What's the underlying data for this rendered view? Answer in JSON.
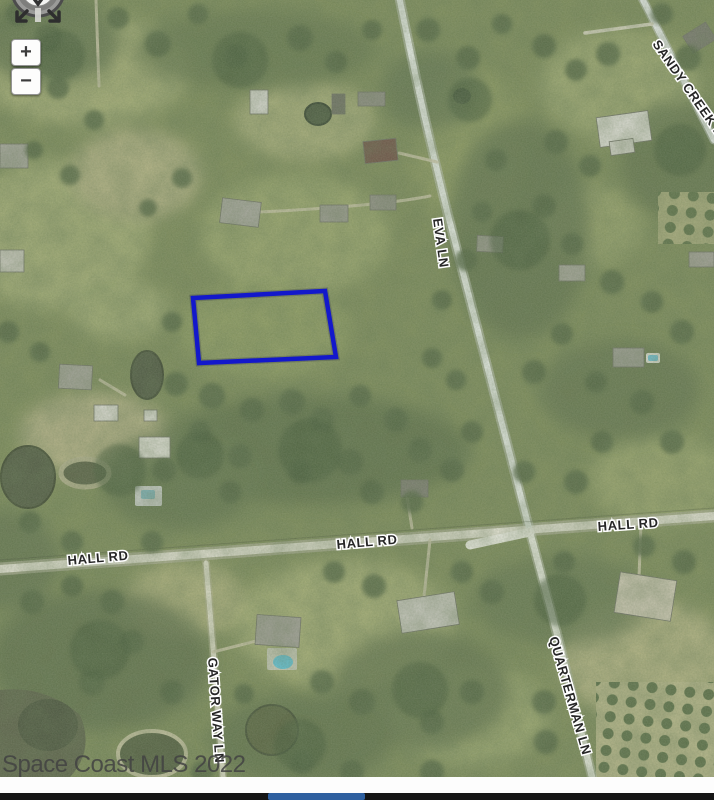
{
  "map": {
    "watermark": "Space Coast MLS 2022",
    "road_labels": [
      {
        "id": "sandy-creek-ln",
        "text": "SANDY CREEK LN",
        "x": 652,
        "y": 44,
        "rotate": 55
      },
      {
        "id": "eva-ln",
        "text": "EVA LN",
        "x": 433,
        "y": 219,
        "rotate": 82
      },
      {
        "id": "hall-rd-left",
        "text": "HALL RD",
        "x": 68,
        "y": 565,
        "rotate": -5
      },
      {
        "id": "hall-rd-mid",
        "text": "HALL RD",
        "x": 337,
        "y": 549,
        "rotate": -5
      },
      {
        "id": "hall-rd-right",
        "text": "HALL RD",
        "x": 598,
        "y": 531,
        "rotate": -4
      },
      {
        "id": "gator-way-ln",
        "text": "GATOR WAY LN",
        "x": 208,
        "y": 658,
        "rotate": 86
      },
      {
        "id": "quarterman-ln",
        "text": "QUARTERMAN LN",
        "x": 549,
        "y": 638,
        "rotate": 74
      }
    ],
    "parcel": {
      "points": "193,298 325,291 336,357 199,363",
      "color": "#1318cb"
    },
    "controls": {
      "zoom_in": "+",
      "zoom_out": "−"
    },
    "colors": {
      "parcel_outline": "#1318cb",
      "road": "#eceee8",
      "vegetation_base": "#7d8b5a",
      "footer_bar": "#151515",
      "footer_progress": "#2e5f9f"
    }
  },
  "footer": {}
}
